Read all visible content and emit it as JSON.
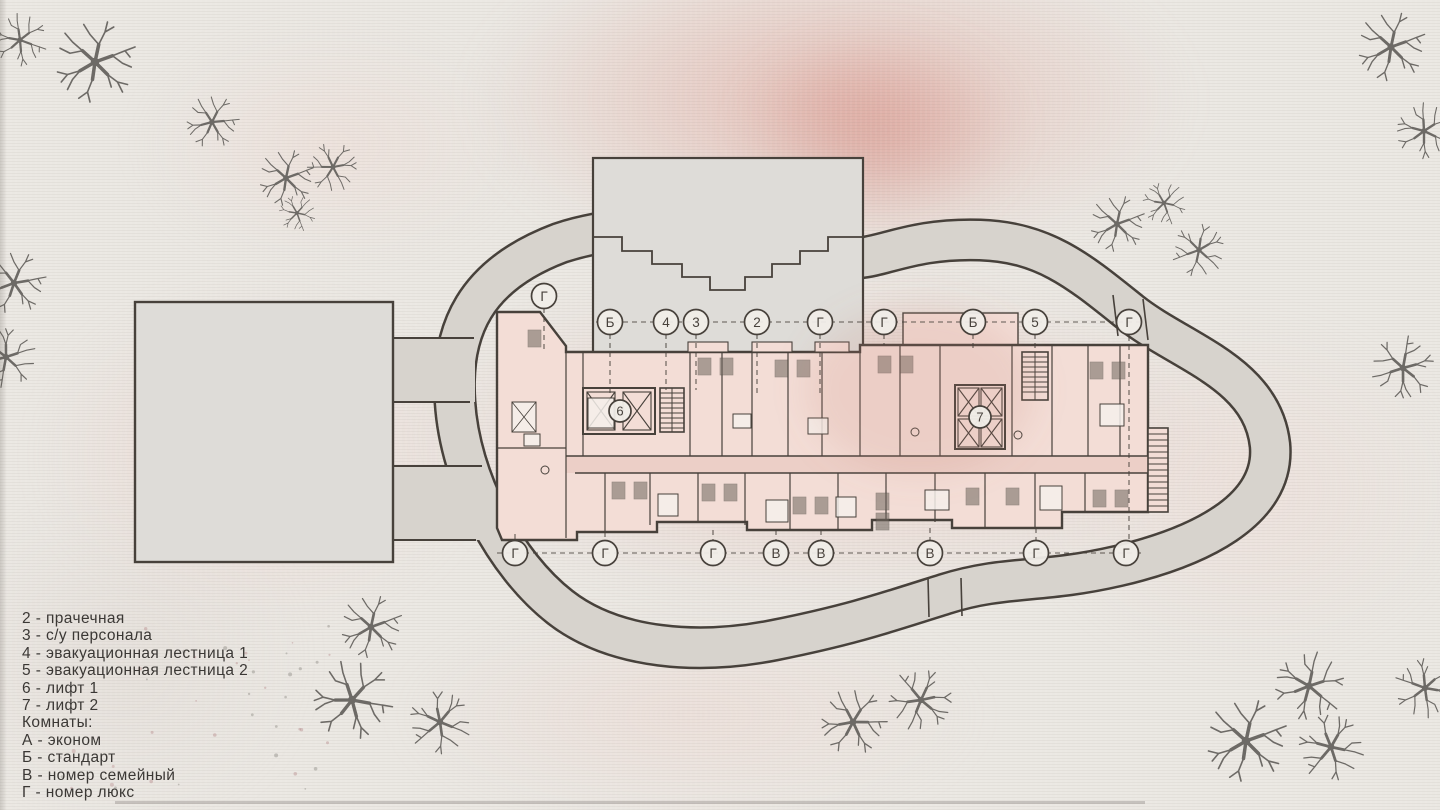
{
  "drawing": {
    "type": "site-plan-floor-plan",
    "legend": {
      "items": [
        "2 - прачечная",
        "3 - с/у персонала",
        "4 - эвакуационная лестница 1",
        "5 - эвакуационная лестница 2",
        "6 - лифт 1",
        "7 - лифт 2",
        "Комнаты:",
        "А - эконом",
        "Б - стандарт",
        "В - номер семейный",
        "Г - номер люкс"
      ]
    },
    "axis_markers": {
      "top": [
        "Г",
        "Б",
        "4",
        "3",
        "2",
        "Г",
        "Г",
        "Б",
        "5",
        "Г"
      ],
      "bottom": [
        "Г",
        "Г",
        "Г",
        "В",
        "В",
        "В",
        "Г",
        "Г"
      ],
      "interior": [
        "6",
        "7"
      ]
    },
    "colors": {
      "paper": "#ebe8e3",
      "wash_pink": "#e2a79d",
      "road_fill": "#d7d3cd",
      "building_gray": "#dedcd8",
      "plan_fill": "#f3ddd6",
      "corridor_fill": "#eccfc7",
      "line_dark": "#47413b",
      "tree": "#6d6a66",
      "furniture_dark": "#6f675f",
      "text": "#3b3835"
    }
  }
}
